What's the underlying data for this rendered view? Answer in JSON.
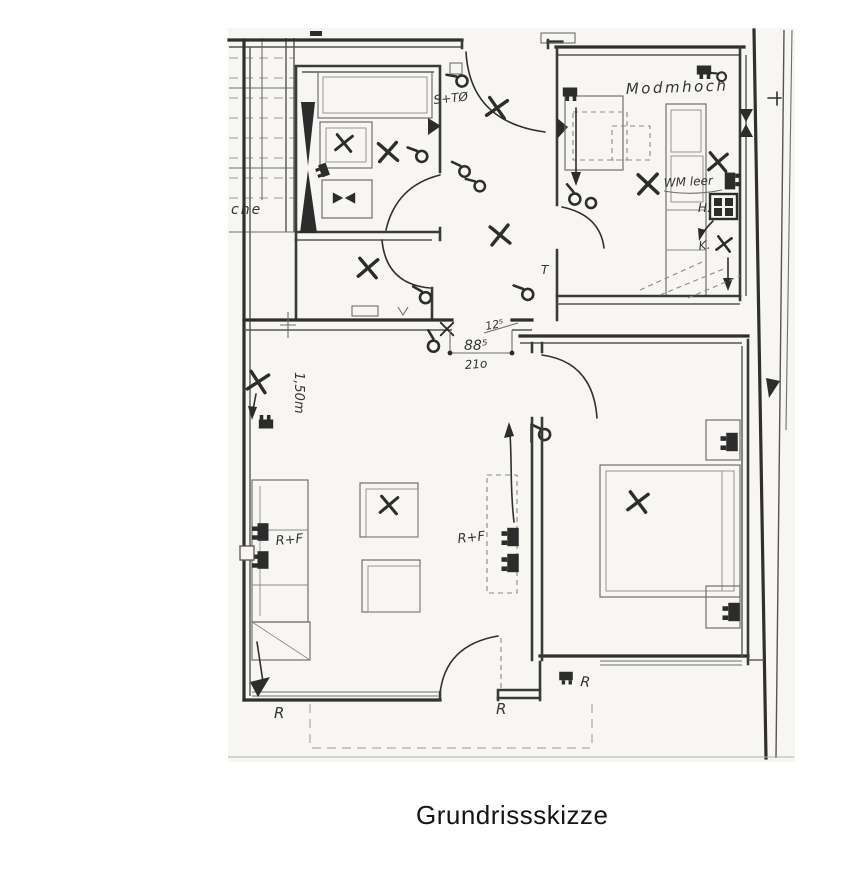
{
  "caption": "Grundrissskizze",
  "plan": {
    "labels": {
      "entrance_switch": "S+TØ",
      "kitchen_header": "Modmhoch",
      "washing_machine": "WM leer",
      "stove": "H.",
      "fridge": "K.",
      "tee_mark": "T",
      "left_edge_partial": "che",
      "dim_wall": "12⁵",
      "dim_door_width": "88⁵",
      "dim_door_height": "21o",
      "height_note": "1,50m",
      "antenna_socket_left": "R+F",
      "antenna_socket_mid": "R+F",
      "shutter_left": "R",
      "shutter_center": "R",
      "shutter_right": "R"
    }
  }
}
